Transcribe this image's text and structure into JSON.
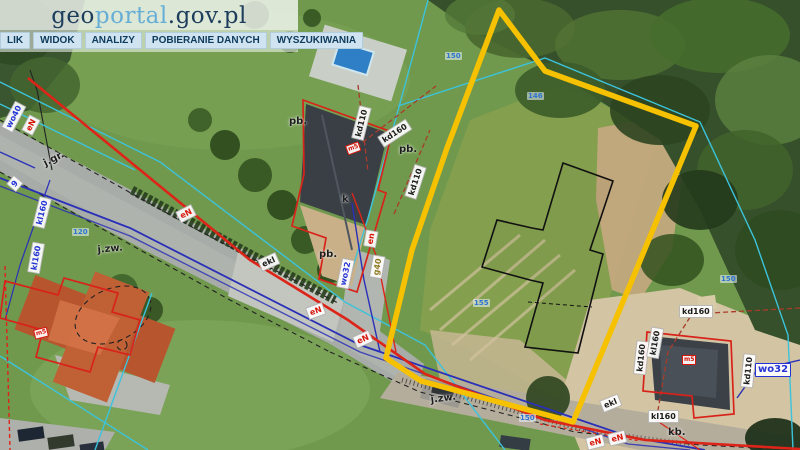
{
  "branding": {
    "logo_prefix": "geo",
    "logo_mid": "portal",
    "logo_suffix": ".gov.pl"
  },
  "menu": {
    "items": [
      "LIK",
      "WIDOK",
      "ANALIZY",
      "POBIERANIE DANYCH",
      "WYSZUKIWANIA"
    ]
  },
  "map": {
    "colors": {
      "selection_outline": "#f6c100",
      "building_outline": "#d8231a",
      "parcel_line": "#3cc3dc",
      "water_line": "#2a2fb8",
      "power_line": "#dd2418",
      "planned_building": "#111111"
    },
    "labels": [
      {
        "text": "wo40",
        "type": "blue",
        "x": 1,
        "y": 127,
        "rot": -62
      },
      {
        "text": "eN",
        "type": "red",
        "x": 21,
        "y": 130,
        "rot": -62
      },
      {
        "text": "j.gr.",
        "type": "plain",
        "x": 40,
        "y": 160,
        "rot": -27
      },
      {
        "text": "9",
        "type": "blue",
        "x": 6,
        "y": 184,
        "rot": -50
      },
      {
        "text": "kl160",
        "type": "blue",
        "x": 32,
        "y": 226,
        "rot": -76
      },
      {
        "text": "kl160",
        "type": "blue",
        "x": 27,
        "y": 272,
        "rot": -80
      },
      {
        "text": "j.zw.",
        "type": "plain",
        "x": 95,
        "y": 245,
        "rot": -5
      },
      {
        "text": "eN",
        "type": "red",
        "x": 175,
        "y": 212,
        "rot": -27
      },
      {
        "text": "ekl",
        "type": "black",
        "x": 257,
        "y": 260,
        "rot": -24
      },
      {
        "text": "pb.",
        "type": "plain",
        "x": 317,
        "y": 249,
        "rot": 0
      },
      {
        "text": "k",
        "type": "plain",
        "x": 340,
        "y": 194,
        "rot": 0
      },
      {
        "text": "pb.",
        "type": "plain",
        "x": 287,
        "y": 116,
        "rot": 0
      },
      {
        "text": "kd110",
        "type": "black",
        "x": 351,
        "y": 138,
        "rot": -76
      },
      {
        "text": "kd160",
        "type": "black",
        "x": 377,
        "y": 137,
        "rot": -33
      },
      {
        "text": "pb.",
        "type": "plain",
        "x": 397,
        "y": 144,
        "rot": 0
      },
      {
        "text": "kd110",
        "type": "black",
        "x": 404,
        "y": 196,
        "rot": -72
      },
      {
        "text": "m5",
        "type": "red-tiny",
        "x": 345,
        "y": 146,
        "rot": -20
      },
      {
        "text": "wo32",
        "type": "blue",
        "x": 336,
        "y": 287,
        "rot": -78
      },
      {
        "text": "en",
        "type": "red",
        "x": 363,
        "y": 246,
        "rot": -80
      },
      {
        "text": "g40",
        "type": "olive",
        "x": 369,
        "y": 277,
        "rot": -80
      },
      {
        "text": "eN",
        "type": "red",
        "x": 305,
        "y": 308,
        "rot": -20
      },
      {
        "text": "eN",
        "type": "red",
        "x": 352,
        "y": 337,
        "rot": -24
      },
      {
        "text": "j.zw.",
        "type": "plain",
        "x": 428,
        "y": 395,
        "rot": -7
      },
      {
        "text": "ekl",
        "type": "black",
        "x": 599,
        "y": 401,
        "rot": -22
      },
      {
        "text": "eN",
        "type": "red",
        "x": 585,
        "y": 438,
        "rot": -14
      },
      {
        "text": "eN",
        "type": "red",
        "x": 607,
        "y": 434,
        "rot": -14
      },
      {
        "text": "kd160",
        "type": "black",
        "x": 633,
        "y": 374,
        "rot": -84
      },
      {
        "text": "kl160",
        "type": "black",
        "x": 646,
        "y": 357,
        "rot": -80
      },
      {
        "text": "kd110",
        "type": "black",
        "x": 740,
        "y": 387,
        "rot": -84
      },
      {
        "text": "wo32",
        "type": "blue-box",
        "x": 755,
        "y": 363,
        "rot": 0
      },
      {
        "text": "kd160",
        "type": "black",
        "x": 679,
        "y": 305,
        "rot": 0
      },
      {
        "text": "kl160",
        "type": "black",
        "x": 648,
        "y": 410,
        "rot": 0
      },
      {
        "text": "kb.",
        "type": "plain",
        "x": 666,
        "y": 427,
        "rot": 0
      },
      {
        "text": "m5",
        "type": "red-tiny",
        "x": 682,
        "y": 355,
        "rot": 0
      },
      {
        "text": "m5",
        "type": "red-tiny",
        "x": 33,
        "y": 330,
        "rot": -14
      }
    ],
    "parcel_numbers": [
      {
        "text": "150",
        "x": 445,
        "y": 52
      },
      {
        "text": "146",
        "x": 527,
        "y": 92
      },
      {
        "text": "150",
        "x": 720,
        "y": 275
      },
      {
        "text": "155",
        "x": 473,
        "y": 299
      },
      {
        "text": "150",
        "x": 519,
        "y": 414
      },
      {
        "text": "120",
        "x": 72,
        "y": 228
      }
    ]
  }
}
